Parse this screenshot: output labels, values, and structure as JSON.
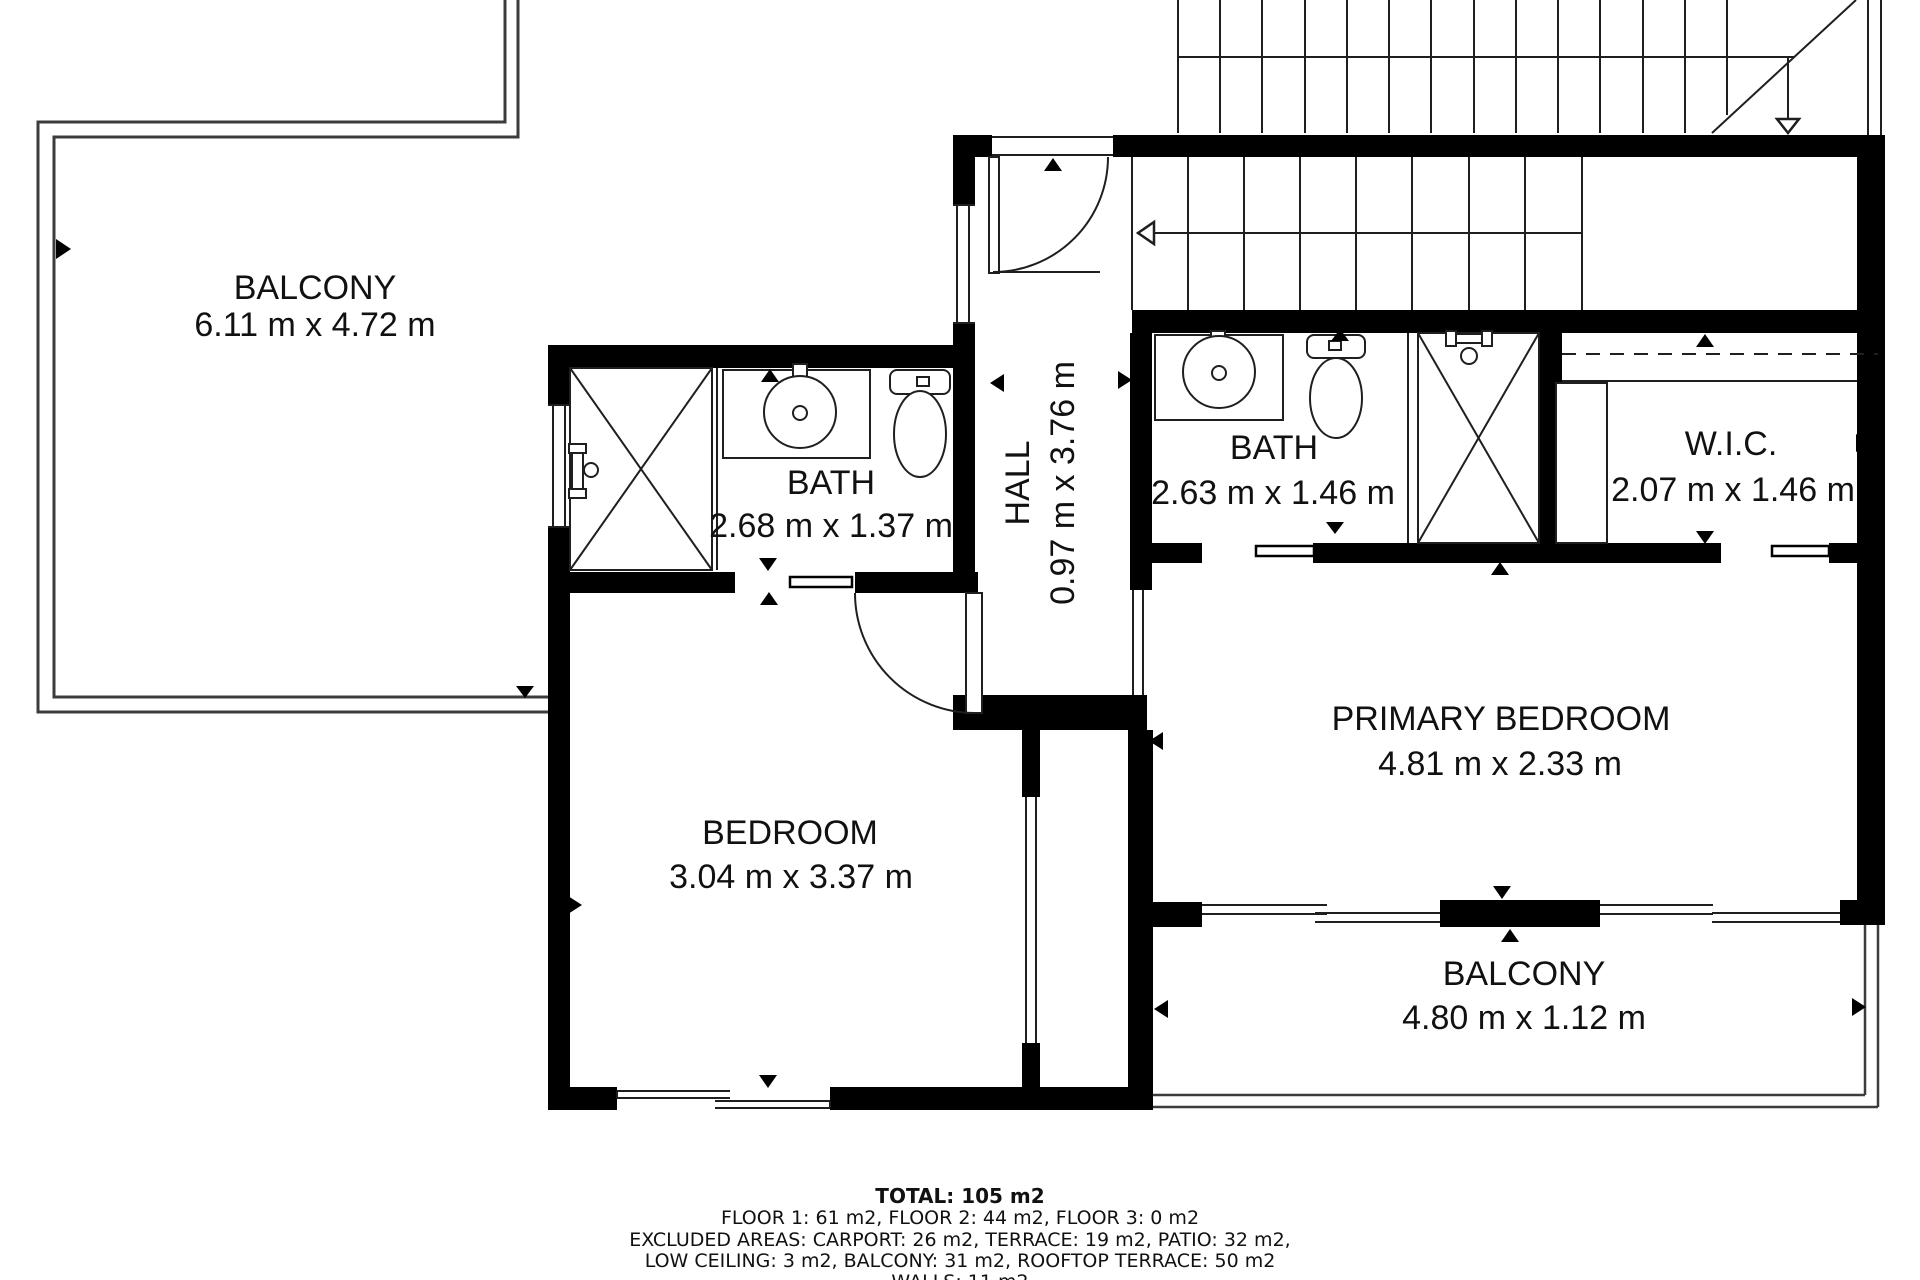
{
  "rooms": {
    "balcony_top": {
      "label": "BALCONY",
      "dimensions": "6.11 m x 4.72 m"
    },
    "bath_left": {
      "label": "BATH",
      "dimensions": "2.68 m x 1.37 m"
    },
    "hall": {
      "label": "HALL",
      "dimensions": "0.97 m x 3.76 m"
    },
    "bath_right": {
      "label": "BATH",
      "dimensions": "2.63 m x 1.46 m"
    },
    "wic": {
      "label": "W.I.C.",
      "dimensions": "2.07 m x 1.46 m"
    },
    "primary_bedroom": {
      "label": "PRIMARY BEDROOM",
      "dimensions": "4.81 m x 2.33 m"
    },
    "bedroom": {
      "label": "BEDROOM",
      "dimensions": "3.04 m x 3.37 m"
    },
    "balcony_bottom": {
      "label": "BALCONY",
      "dimensions": "4.80 m x 1.12 m"
    }
  },
  "summary": {
    "total": "TOTAL: 105 m2",
    "floors": "FLOOR 1: 61 m2, FLOOR 2: 44 m2, FLOOR 3: 0 m2",
    "excluded": "EXCLUDED AREAS: CARPORT: 26 m2, TERRACE: 19 m2, PATIO: 32 m2,",
    "excluded2": "LOW CEILING: 3 m2, BALCONY: 31 m2, ROOFTOP TERRACE: 50 m2",
    "walls": "WALLS: 11 m2"
  },
  "colors": {
    "wall": "#000000",
    "background": "#ffffff",
    "thin_line": "#1f1f1f",
    "outline_gray": "#3c3c3c",
    "text": "#111111"
  }
}
